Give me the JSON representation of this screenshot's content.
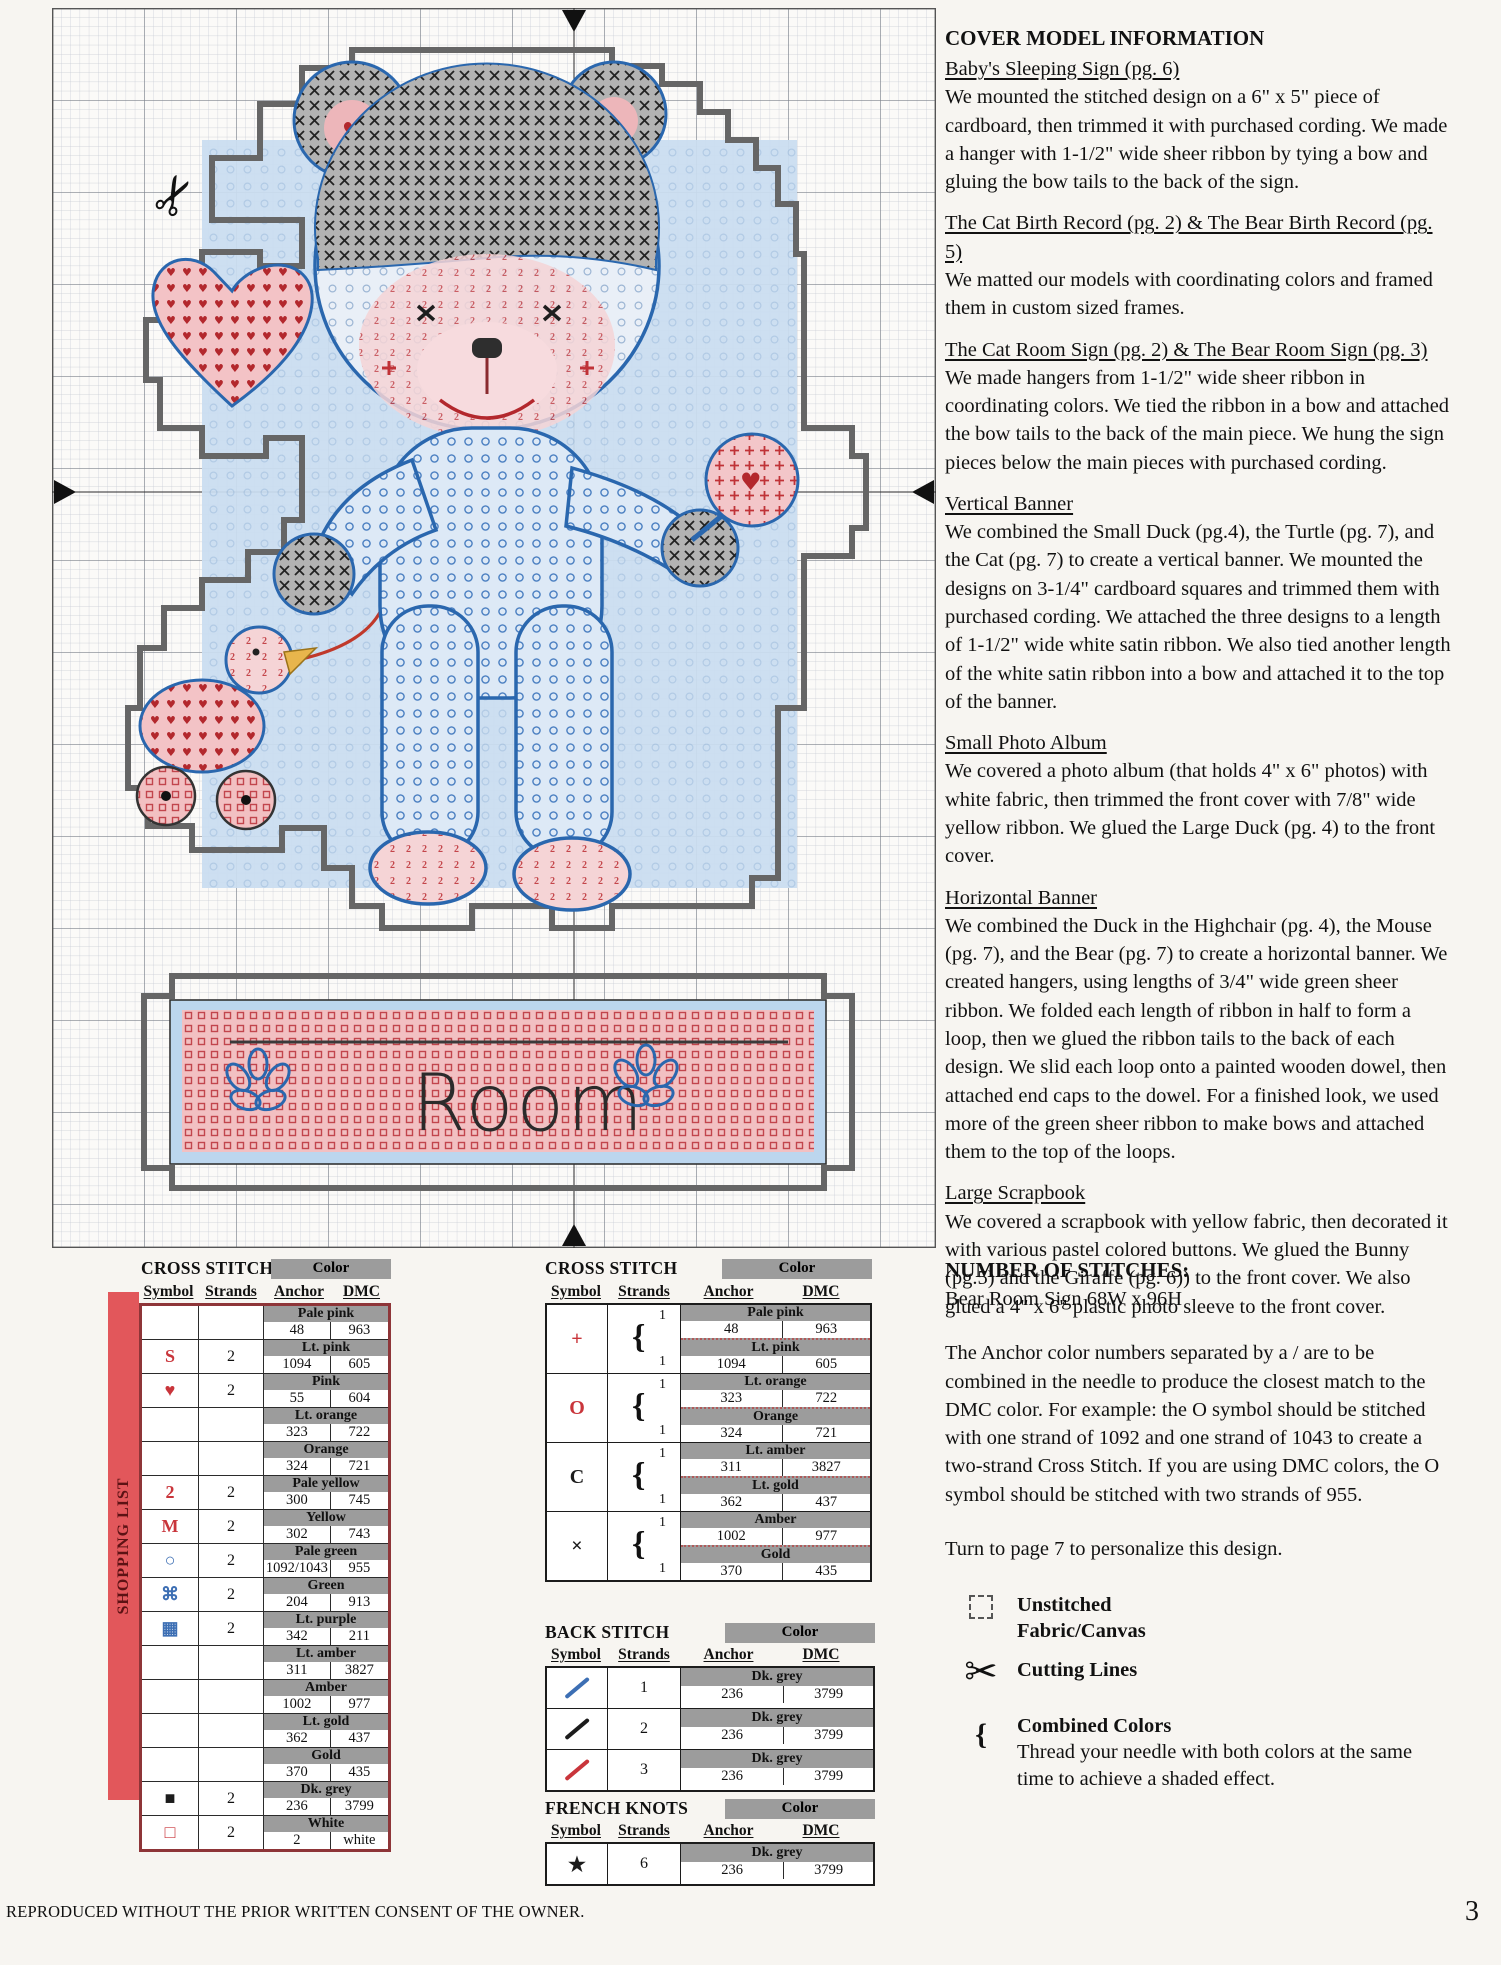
{
  "accent": {
    "red": "#c9353b",
    "blue": "#3d6fb4",
    "band_grey": "#9c9c9c",
    "bar_red": "#e2575b",
    "chart_blue": "#2a67ae"
  },
  "chart": {
    "sign_text": "Room"
  },
  "cover_model_information": {
    "title": "COVER MODEL INFORMATION",
    "sections": [
      {
        "heading": "Baby's Sleeping Sign (pg. 6)",
        "body": "We mounted the stitched design on a 6\" x 5\" piece of cardboard, then trimmed it with purchased cording. We made a hanger with 1-1/2\" wide sheer ribbon by tying a bow and gluing the bow tails to the back of the sign."
      },
      {
        "heading": "The Cat Birth Record (pg. 2) & The Bear Birth Record (pg. 5)",
        "body": "We matted our models with coordinating colors and framed them in custom sized frames."
      },
      {
        "heading": "The Cat Room Sign (pg. 2) & The Bear Room Sign (pg. 3)",
        "body": "We made hangers from 1-1/2\" wide sheer ribbon in coordinating colors. We tied the ribbon in a bow and attached the bow tails to the back of the main piece. We hung the sign pieces below the main pieces with purchased cording."
      },
      {
        "heading": "Vertical Banner",
        "body": "We combined the Small Duck (pg.4), the Turtle (pg. 7), and the Cat (pg. 7) to create a vertical banner. We mounted the designs on 3-1/4\" cardboard squares and trimmed them with purchased cording. We attached the three designs to a length of 1-1/2\" wide white satin ribbon. We also tied another length of the white satin ribbon into a bow and attached it to the top of the banner."
      },
      {
        "heading": "Small Photo Album",
        "body": "We covered a photo album (that holds 4\" x 6\" photos) with white fabric, then trimmed the front cover with 7/8\" wide yellow ribbon. We glued the Large Duck (pg. 4) to the front cover."
      },
      {
        "heading": "Horizontal Banner",
        "body": "We combined the Duck in the Highchair (pg. 4), the Mouse (pg. 7), and the Bear (pg. 7) to create a horizontal banner. We created hangers, using lengths of 3/4\" wide green sheer ribbon. We folded each length of ribbon in half to form a loop, then we glued the ribbon tails to the back of each design. We slid each loop onto a painted wooden dowel, then attached end caps to the dowel. For a finished look, we used more of the green sheer ribbon to make bows and attached them to the top of the loops."
      },
      {
        "heading": "Large Scrapbook",
        "body": "We covered a scrapbook with yellow fabric, then decorated it with various pastel colored buttons. We glued the Bunny (pg.5) and the Giraffe (pg. 6)) to the front cover. We also glued a 4\" x 6\" plastic photo sleeve to the front cover."
      }
    ]
  },
  "shopping_list": {
    "label": "SHOPPING LIST",
    "cross_stitch": {
      "title": "CROSS STITCH",
      "color_header": "Color",
      "columns": {
        "symbol": "Symbol",
        "strands": "Strands",
        "anchor": "Anchor",
        "dmc": "DMC"
      },
      "rows": [
        {
          "symbol": "",
          "sym_style": "",
          "strands": "",
          "color": "Pale pink",
          "anchor": "48",
          "dmc": "963"
        },
        {
          "symbol": "S",
          "sym_style": "red",
          "strands": "2",
          "color": "Lt. pink",
          "anchor": "1094",
          "dmc": "605"
        },
        {
          "symbol": "♥",
          "sym_style": "red",
          "strands": "2",
          "color": "Pink",
          "anchor": "55",
          "dmc": "604"
        },
        {
          "symbol": "",
          "sym_style": "",
          "strands": "",
          "color": "Lt. orange",
          "anchor": "323",
          "dmc": "722"
        },
        {
          "symbol": "",
          "sym_style": "",
          "strands": "",
          "color": "Orange",
          "anchor": "324",
          "dmc": "721"
        },
        {
          "symbol": "2",
          "sym_style": "red",
          "strands": "2",
          "color": "Pale yellow",
          "anchor": "300",
          "dmc": "745"
        },
        {
          "symbol": "M",
          "sym_style": "red",
          "strands": "2",
          "color": "Yellow",
          "anchor": "302",
          "dmc": "743"
        },
        {
          "symbol": "○",
          "sym_style": "blue",
          "strands": "2",
          "color": "Pale green",
          "anchor": "1092/1043",
          "dmc": "955"
        },
        {
          "symbol": "⌘",
          "sym_style": "blue",
          "strands": "2",
          "color": "Green",
          "anchor": "204",
          "dmc": "913"
        },
        {
          "symbol": "▦",
          "sym_style": "blue",
          "strands": "2",
          "color": "Lt. purple",
          "anchor": "342",
          "dmc": "211"
        },
        {
          "symbol": "",
          "sym_style": "",
          "strands": "",
          "color": "Lt. amber",
          "anchor": "311",
          "dmc": "3827"
        },
        {
          "symbol": "",
          "sym_style": "",
          "strands": "",
          "color": "Amber",
          "anchor": "1002",
          "dmc": "977"
        },
        {
          "symbol": "",
          "sym_style": "",
          "strands": "",
          "color": "Lt. gold",
          "anchor": "362",
          "dmc": "437"
        },
        {
          "symbol": "",
          "sym_style": "",
          "strands": "",
          "color": "Gold",
          "anchor": "370",
          "dmc": "435"
        },
        {
          "symbol": "■",
          "sym_style": "black",
          "strands": "2",
          "color": "Dk. grey",
          "anchor": "236",
          "dmc": "3799"
        },
        {
          "symbol": "□",
          "sym_style": "red",
          "strands": "2",
          "color": "White",
          "anchor": "2",
          "dmc": "white"
        }
      ]
    }
  },
  "combined_cross_stitch": {
    "title": "CROSS STITCH",
    "color_header": "Color",
    "columns": {
      "symbol": "Symbol",
      "strands": "Strands",
      "anchor": "Anchor",
      "dmc": "DMC"
    },
    "rows": [
      {
        "symbol": "+",
        "sym_style": "red",
        "strands": [
          "1",
          "1"
        ],
        "colors": [
          {
            "name": "Pale pink",
            "anchor": "48",
            "dmc": "963"
          },
          {
            "name": "Lt. pink",
            "anchor": "1094",
            "dmc": "605"
          }
        ]
      },
      {
        "symbol": "O",
        "sym_style": "red",
        "strands": [
          "1",
          "1"
        ],
        "colors": [
          {
            "name": "Lt. orange",
            "anchor": "323",
            "dmc": "722"
          },
          {
            "name": "Orange",
            "anchor": "324",
            "dmc": "721"
          }
        ]
      },
      {
        "symbol": "C",
        "sym_style": "black",
        "strands": [
          "1",
          "1"
        ],
        "colors": [
          {
            "name": "Lt. amber",
            "anchor": "311",
            "dmc": "3827"
          },
          {
            "name": "Lt. gold",
            "anchor": "362",
            "dmc": "437"
          }
        ]
      },
      {
        "symbol": "×",
        "sym_style": "black",
        "strands": [
          "1",
          "1"
        ],
        "colors": [
          {
            "name": "Amber",
            "anchor": "1002",
            "dmc": "977"
          },
          {
            "name": "Gold",
            "anchor": "370",
            "dmc": "435"
          }
        ]
      }
    ]
  },
  "back_stitch": {
    "title": "BACK STITCH",
    "color_header": "Color",
    "columns": {
      "symbol": "Symbol",
      "strands": "Strands",
      "anchor": "Anchor",
      "dmc": "DMC"
    },
    "rows": [
      {
        "symbol": "slash",
        "line_color": "#3d6fb4",
        "strands": "1",
        "color": "Dk. grey",
        "anchor": "236",
        "dmc": "3799"
      },
      {
        "symbol": "slash",
        "line_color": "#1c1c1c",
        "strands": "2",
        "color": "Dk. grey",
        "anchor": "236",
        "dmc": "3799"
      },
      {
        "symbol": "slash",
        "line_color": "#c9353b",
        "strands": "3",
        "color": "Dk. grey",
        "anchor": "236",
        "dmc": "3799"
      }
    ]
  },
  "french_knots": {
    "title": "FRENCH KNOTS",
    "color_header": "Color",
    "columns": {
      "symbol": "Symbol",
      "strands": "Strands",
      "anchor": "Anchor",
      "dmc": "DMC"
    },
    "rows": [
      {
        "symbol": "★",
        "sym_style": "black",
        "strands": "6",
        "color": "Dk. grey",
        "anchor": "236",
        "dmc": "3799"
      }
    ]
  },
  "number_of_stitches": {
    "title": "NUMBER OF STITCHES:",
    "subtitle": "Bear Room Sign 68W x 96H",
    "paragraph": "The Anchor color numbers separated by a / are to be combined in the needle to produce the closest match to the DMC color. For example: the O symbol should be stitched with one strand of 1092 and one strand of 1043 to create a two-strand Cross Stitch. If you are using DMC colors, the O symbol should be stitched with two strands of 955.",
    "note": "Turn to page 7 to personalize this design.",
    "legend": [
      {
        "icon": "unstitched-square",
        "label": "Unstitched\nFabric/Canvas",
        "description": ""
      },
      {
        "icon": "scissors",
        "label": "Cutting Lines",
        "description": ""
      },
      {
        "icon": "brace",
        "label": "Combined Colors",
        "description": "Thread your needle with both colors at the same time to achieve a shaded effect."
      }
    ]
  },
  "footer": {
    "left": "REPRODUCED WITHOUT THE PRIOR WRITTEN CONSENT OF THE OWNER.",
    "page_number": "3"
  }
}
